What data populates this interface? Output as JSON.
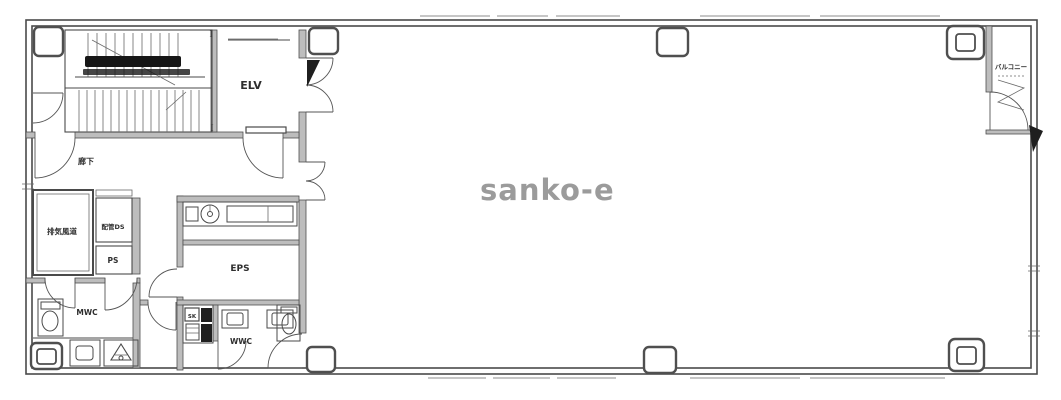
{
  "watermark": "sanko-e",
  "colors": {
    "ink": "#4a4a4a",
    "wall_fill": "#bdbdbd",
    "dark_fill": "#1f1f1f",
    "watermark_gray": "#9b9b9b",
    "background": "#ffffff"
  },
  "rooms": {
    "elevator": {
      "label": "ELV"
    },
    "stair_hall": {
      "label": "廊下"
    },
    "exhaust_duct": {
      "label": "排気風道"
    },
    "pipe_duct": {
      "label": "配管DS"
    },
    "pipe_shaft": {
      "label": "PS"
    },
    "mens_wc": {
      "label": "MWC"
    },
    "womens_wc": {
      "label": "WWC"
    },
    "electrical_shaft": {
      "label": "EPS"
    },
    "slop_sink": {
      "label": "SK"
    },
    "balcony": {
      "label": "バルコニー"
    }
  },
  "markers": {
    "section_top": "I",
    "section_bottom": "I"
  }
}
